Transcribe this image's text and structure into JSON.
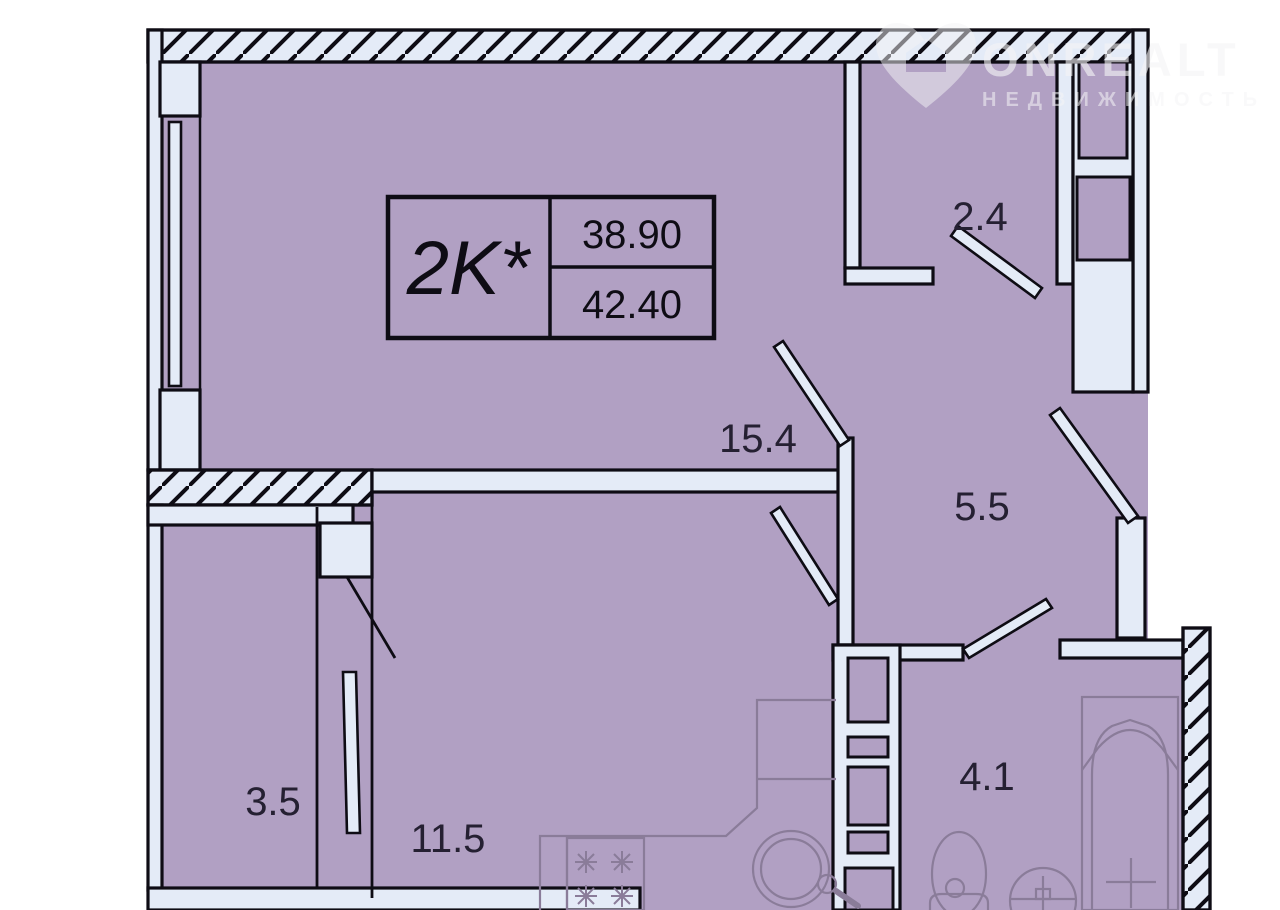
{
  "plan": {
    "info_box": {
      "type_label": "2K*",
      "living_area": "38.90",
      "total_area": "42.40"
    },
    "rooms": [
      {
        "key": "wardrobe",
        "area": "2.4"
      },
      {
        "key": "living-room",
        "area": "15.4"
      },
      {
        "key": "hallway",
        "area": "5.5"
      },
      {
        "key": "storage",
        "area": "3.5"
      },
      {
        "key": "kitchen",
        "area": "11.5"
      },
      {
        "key": "bathroom",
        "area": "4.1"
      }
    ]
  },
  "watermark": {
    "brand": "ONREALT",
    "subtitle": "НЕДВИЖИМОСТЬ"
  },
  "colors": {
    "room_fill": "#b1a0c3",
    "wall_fill": "#e4ebf7",
    "outline": "#0e0c14",
    "fixture_line": "#8a7c99",
    "label_text": "#252032"
  }
}
